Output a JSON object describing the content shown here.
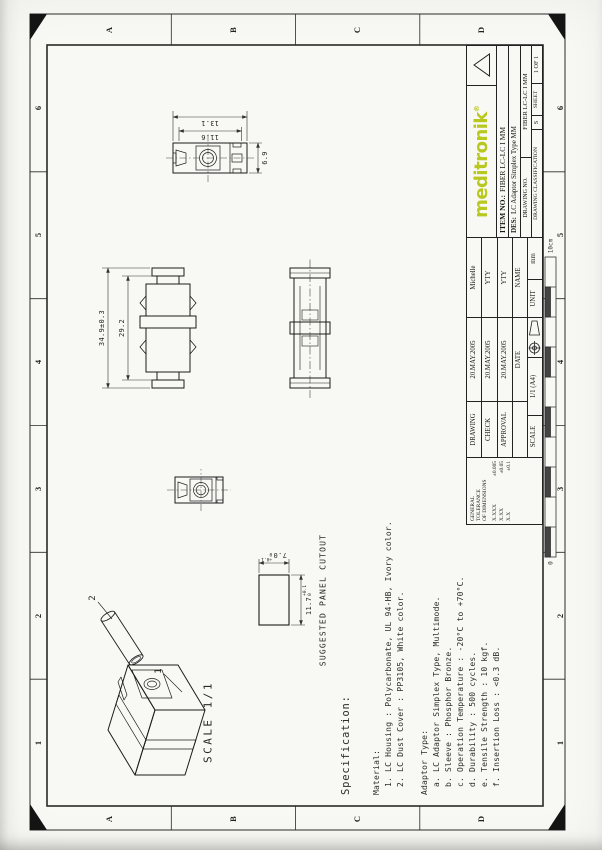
{
  "sheet": {
    "zones_cols": [
      "1",
      "2",
      "3",
      "4",
      "5",
      "6"
    ],
    "zones_rows": [
      "A",
      "B",
      "C",
      "D"
    ],
    "ruler": {
      "start": "0",
      "end": "10cm"
    }
  },
  "logo": {
    "text": "meditronik",
    "reg": "®"
  },
  "title_block": {
    "tolerance": {
      "l1": "GENERAL",
      "l2": "TOLERANCE",
      "l3": "OF DIMENSIONS",
      "r1k": "X.XXX",
      "r1v": "±0.005",
      "r2k": "X.XX",
      "r2v": "±0.05",
      "r3k": "X.X",
      "r3v": "±0.1"
    },
    "rows": [
      {
        "role": "DRAWING",
        "date": "20.MAY.2005",
        "name": "Michelle"
      },
      {
        "role": "CHECK",
        "date": "20.MAY.2005",
        "name": "YTY"
      },
      {
        "role": "APPROVAL",
        "date": "20.MAY.2005",
        "name": "YTY"
      }
    ],
    "date_header": "DATE",
    "name_header": "NAME",
    "scale_label": "SCALE",
    "scale_value": "1/1 (A4)",
    "unit_label": "UNIT",
    "unit_value": "mm",
    "item_label": "ITEM NO.:",
    "item_value": "FIBER LC-LC I MM",
    "des_label": "DES:",
    "des_value": "LC  Adaptor Simplex Type MM",
    "drawing_no_label": "DRAWING NO.",
    "drawing_no_value": "FIBER LC-LC I MM",
    "class_label": "DRAWING CLASSIFICATION",
    "class_value": "S",
    "sheet_label": "SHEET",
    "sheet_value": "1 OF 1"
  },
  "views": {
    "iso": {
      "balloon_body": "1",
      "balloon_cover": "2",
      "scale_note": "SCALE 1/1"
    },
    "side": {
      "dim_overall": "34.9±0.3",
      "dim_body": "29.2"
    },
    "end": {
      "dim_outer": "13.1",
      "dim_inner": "11.6",
      "dim_width": "6.9"
    },
    "panel": {
      "label": "SUGGESTED PANEL CUTOUT",
      "dim_width": "11.7",
      "dim_height": "7.0",
      "tol_plus": "+0.1",
      "tol_minus": "0"
    }
  },
  "specification": {
    "title": "Specification:",
    "material_heading": "Material:",
    "material_items": [
      "1. LC Housing : Polycarbonate, UL 94-HB, Ivory color.",
      "2. LC Dust Cover : PP3105, White color."
    ],
    "adaptor_heading": "Adaptor Type:",
    "adaptor_items": [
      "a. LC Adaptor Simplex Type, Multimode.",
      "b. Sleeve : Phosphor Bronze.",
      "c. Operation Temperature : -20°C to +70°C.",
      "d. Durability : 500 cycles.",
      "e. Tensile Strength : 10 kgf.",
      "f. Insertion Loss : <0.3 dB."
    ]
  },
  "colors": {
    "logo": "#b9c81f",
    "line": "#1f1f1f",
    "paper": "#f8f8f4"
  }
}
